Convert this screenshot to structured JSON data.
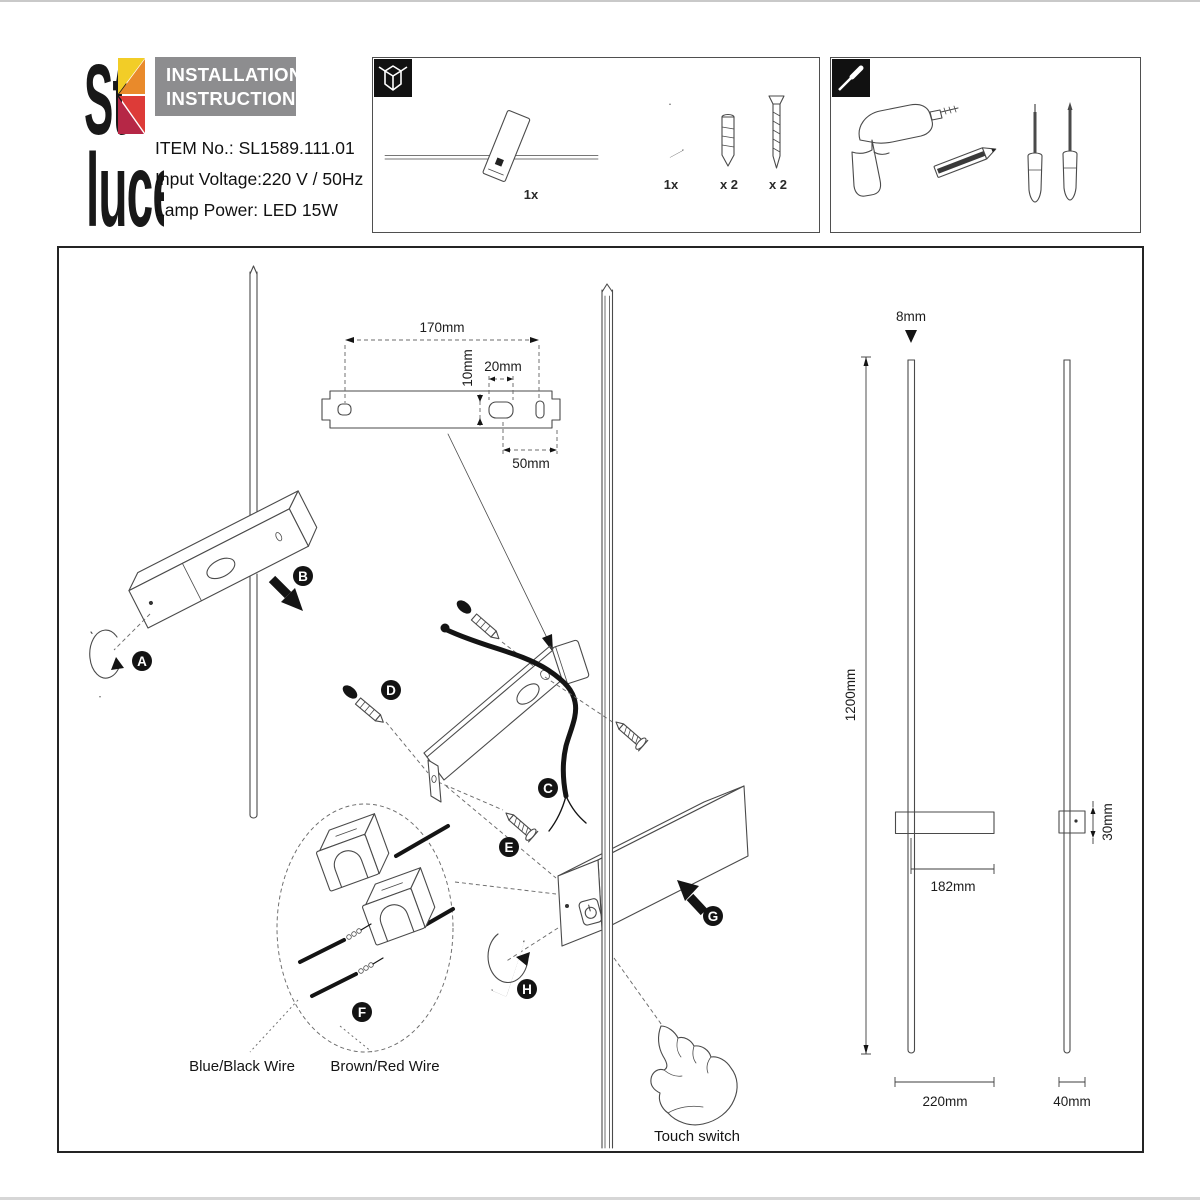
{
  "header": {
    "brand": {
      "top": "St",
      "bottom": "luce"
    },
    "title_line1": "INSTALLATION",
    "title_line2": "INSTRUCTIONS",
    "item_no": "ITEM No.: SL1589.111.01",
    "input_voltage": "Input Voltage:220 V / 50Hz",
    "lamp_power": "Lamp Power: LED 15W"
  },
  "package_box": {
    "icon": "package-box-icon",
    "lamp_qty": "1x",
    "hex_key_qty": "1x",
    "wall_plug_qty": "x 2",
    "screw_qty": "x 2"
  },
  "tools_box": {
    "icon": "screwdriver-icon",
    "tools": [
      "drill",
      "pencil",
      "flat-screwdriver",
      "phillips-screwdriver"
    ]
  },
  "steps": {
    "a": "A",
    "b": "B",
    "c": "C",
    "d": "D",
    "e": "E",
    "f": "F",
    "g": "G",
    "h": "H"
  },
  "bracket_dims": {
    "hole_spacing": "170mm",
    "slot_offset": "10mm",
    "slot_width": "20mm",
    "right_offset": "50mm"
  },
  "wiring": {
    "blue_black": "Blue/Black Wire",
    "brown_red": "Brown/Red Wire"
  },
  "switch_label": "Touch switch",
  "product_dims": {
    "rod_diameter": "8mm",
    "total_height": "1200mm",
    "body_length": "182mm",
    "body_height": "30mm",
    "body_width": "220mm",
    "side_width": "40mm"
  },
  "colors": {
    "logo_yellow": "#f2cd27",
    "logo_orange": "#e98a2b",
    "logo_red": "#dd3b38",
    "logo_crimson": "#b62746",
    "title_bg": "#8d8d8f"
  }
}
